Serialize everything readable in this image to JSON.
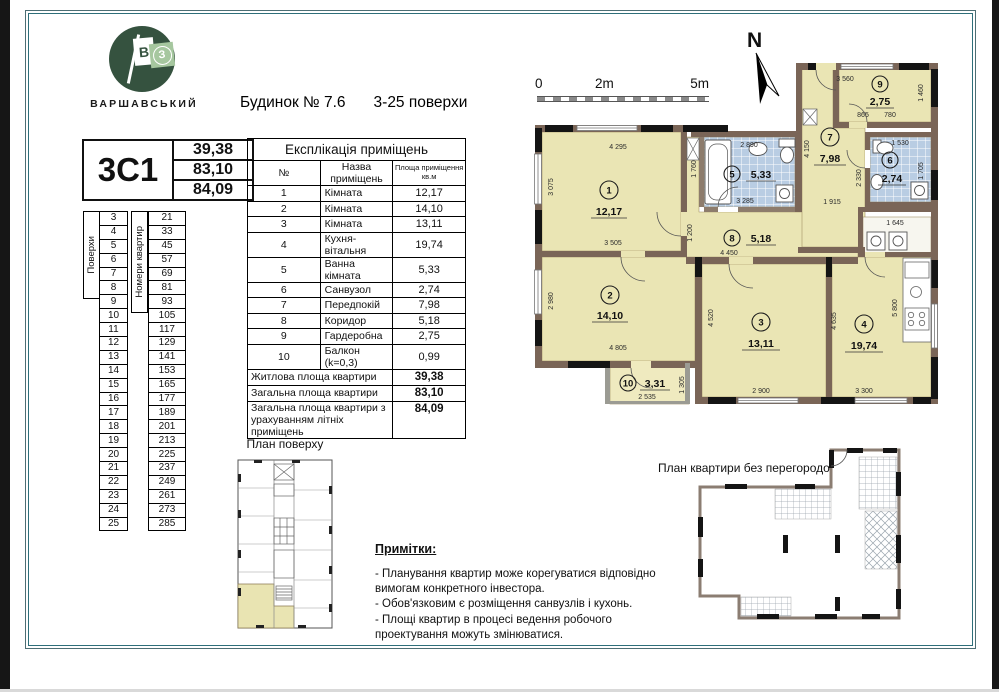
{
  "brand": {
    "name": "ВАРШАВСЬКИЙ",
    "letter_b": "В",
    "letter_z": "З"
  },
  "header": {
    "building": "Будинок № 7.6",
    "floors": "3-25 поверхи"
  },
  "apartment_card": {
    "code": "3С1",
    "living_area": "39,38",
    "total_area": "83,10",
    "total_area_summer": "84,09"
  },
  "explication": {
    "title": "Експлікація приміщень",
    "col_num": "№",
    "col_name": "Назва приміщень",
    "col_area": "Площа приміщення кв.м",
    "rows": [
      {
        "n": "1",
        "name": "Кімната",
        "area": "12,17"
      },
      {
        "n": "2",
        "name": "Кімната",
        "area": "14,10"
      },
      {
        "n": "3",
        "name": "Кімната",
        "area": "13,11"
      },
      {
        "n": "4",
        "name": "Кухня-вітальня",
        "area": "19,74"
      },
      {
        "n": "5",
        "name": "Ванна кімната",
        "area": "5,33"
      },
      {
        "n": "6",
        "name": "Санвузол",
        "area": "2,74"
      },
      {
        "n": "7",
        "name": "Передпокій",
        "area": "7,98"
      },
      {
        "n": "8",
        "name": "Коридор",
        "area": "5,18"
      },
      {
        "n": "9",
        "name": "Гардеробна",
        "area": "2,75"
      },
      {
        "n": "10",
        "name": "Балкон (k=0,3)",
        "area": "0,99"
      }
    ],
    "summary": [
      {
        "name": "Житлова площа квартири",
        "area": "39,38"
      },
      {
        "name": "Загальна площа квартири",
        "area": "83,10"
      },
      {
        "name": "Загальна площа квартири з урахуванням літніх приміщень",
        "area": "84,09"
      }
    ]
  },
  "floors_table": {
    "floors_label": "Поверхи",
    "apts_label": "Номери квартир",
    "rows": [
      {
        "floor": "3",
        "apt": "21"
      },
      {
        "floor": "4",
        "apt": "33"
      },
      {
        "floor": "5",
        "apt": "45"
      },
      {
        "floor": "6",
        "apt": "57"
      },
      {
        "floor": "7",
        "apt": "69"
      },
      {
        "floor": "8",
        "apt": "81"
      },
      {
        "floor": "9",
        "apt": "93"
      },
      {
        "floor": "10",
        "apt": "105"
      },
      {
        "floor": "11",
        "apt": "117"
      },
      {
        "floor": "12",
        "apt": "129"
      },
      {
        "floor": "13",
        "apt": "141"
      },
      {
        "floor": "14",
        "apt": "153"
      },
      {
        "floor": "15",
        "apt": "165"
      },
      {
        "floor": "16",
        "apt": "177"
      },
      {
        "floor": "17",
        "apt": "189"
      },
      {
        "floor": "18",
        "apt": "201"
      },
      {
        "floor": "19",
        "apt": "213"
      },
      {
        "floor": "20",
        "apt": "225"
      },
      {
        "floor": "21",
        "apt": "237"
      },
      {
        "floor": "22",
        "apt": "249"
      },
      {
        "floor": "23",
        "apt": "261"
      },
      {
        "floor": "24",
        "apt": "273"
      },
      {
        "floor": "25",
        "apt": "285"
      }
    ]
  },
  "scale_bar": {
    "t0": "0",
    "t2": "2m",
    "t5": "5m"
  },
  "north_label": "N",
  "plan": {
    "rooms": [
      {
        "num": "1",
        "area": "12,17"
      },
      {
        "num": "2",
        "area": "14,10"
      },
      {
        "num": "3",
        "area": "13,11"
      },
      {
        "num": "4",
        "area": "19,74"
      },
      {
        "num": "5",
        "area": "5,33"
      },
      {
        "num": "6",
        "area": "2,74"
      },
      {
        "num": "7",
        "area": "7,98"
      },
      {
        "num": "8",
        "area": "5,18"
      },
      {
        "num": "9",
        "area": "2,75"
      },
      {
        "num": "10",
        "area": "3,31"
      }
    ],
    "dims": [
      "4 295",
      "3 075",
      "3 505",
      "1 760",
      "2 890",
      "3 285",
      "1 200",
      "4 450",
      "1 915",
      "4 150",
      "3 560",
      "1 460",
      "865",
      "780",
      "1 530",
      "2 330",
      "1 705",
      "1 645",
      "2 980",
      "4 805",
      "2 535",
      "1 305",
      "4 520",
      "2 900",
      "4 635",
      "5 800",
      "3 300"
    ]
  },
  "floor_plan_mini": {
    "title": "План поверху"
  },
  "no_partition_plan": {
    "title": "План квартири без перегородок"
  },
  "notes": {
    "title": "Примітки:",
    "items": [
      "- Планування квартир може корегуватися відповідно вимогам конкретного інвестора.",
      "- Обов'язковим є розміщення санвузлів і кухонь.",
      "- Площі квартир в процесі ведення робочого проектування можуть змінюватися."
    ]
  },
  "colors": {
    "frame_teal": "#2f6f7a",
    "room_fill": "#eae5b4",
    "tile_fill": "#b9cde3",
    "wall_fill": "#7a6557",
    "logo_green": "#35523f",
    "logo_light_green": "#a6c79f"
  }
}
